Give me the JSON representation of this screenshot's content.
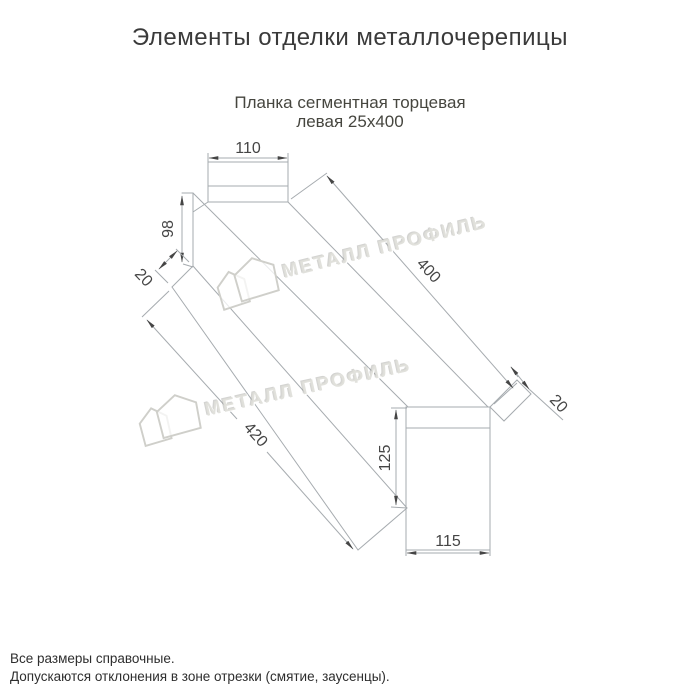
{
  "header": {
    "title": "Элементы отделки металлочерепицы"
  },
  "subtitle": {
    "line1": "Планка сегментная торцевая",
    "line2": "левая 25х400"
  },
  "dims": {
    "top_width": "110",
    "back_height": "98",
    "top_fold": "20",
    "length_back": "400",
    "length_front": "420",
    "end_height": "125",
    "end_width": "115",
    "end_fold": "20"
  },
  "watermark": {
    "text": "МЕТАЛЛ ПРОФИЛЬ"
  },
  "footer": {
    "line1": "Все размеры справочные.",
    "line2": "Допускаются отклонения в зоне отрезки (смятие, заусенцы)."
  },
  "colors": {
    "line": "#a6abaf",
    "dim_text": "#454545",
    "title_text": "#3a3a3a",
    "watermark": "#e2e2de"
  }
}
